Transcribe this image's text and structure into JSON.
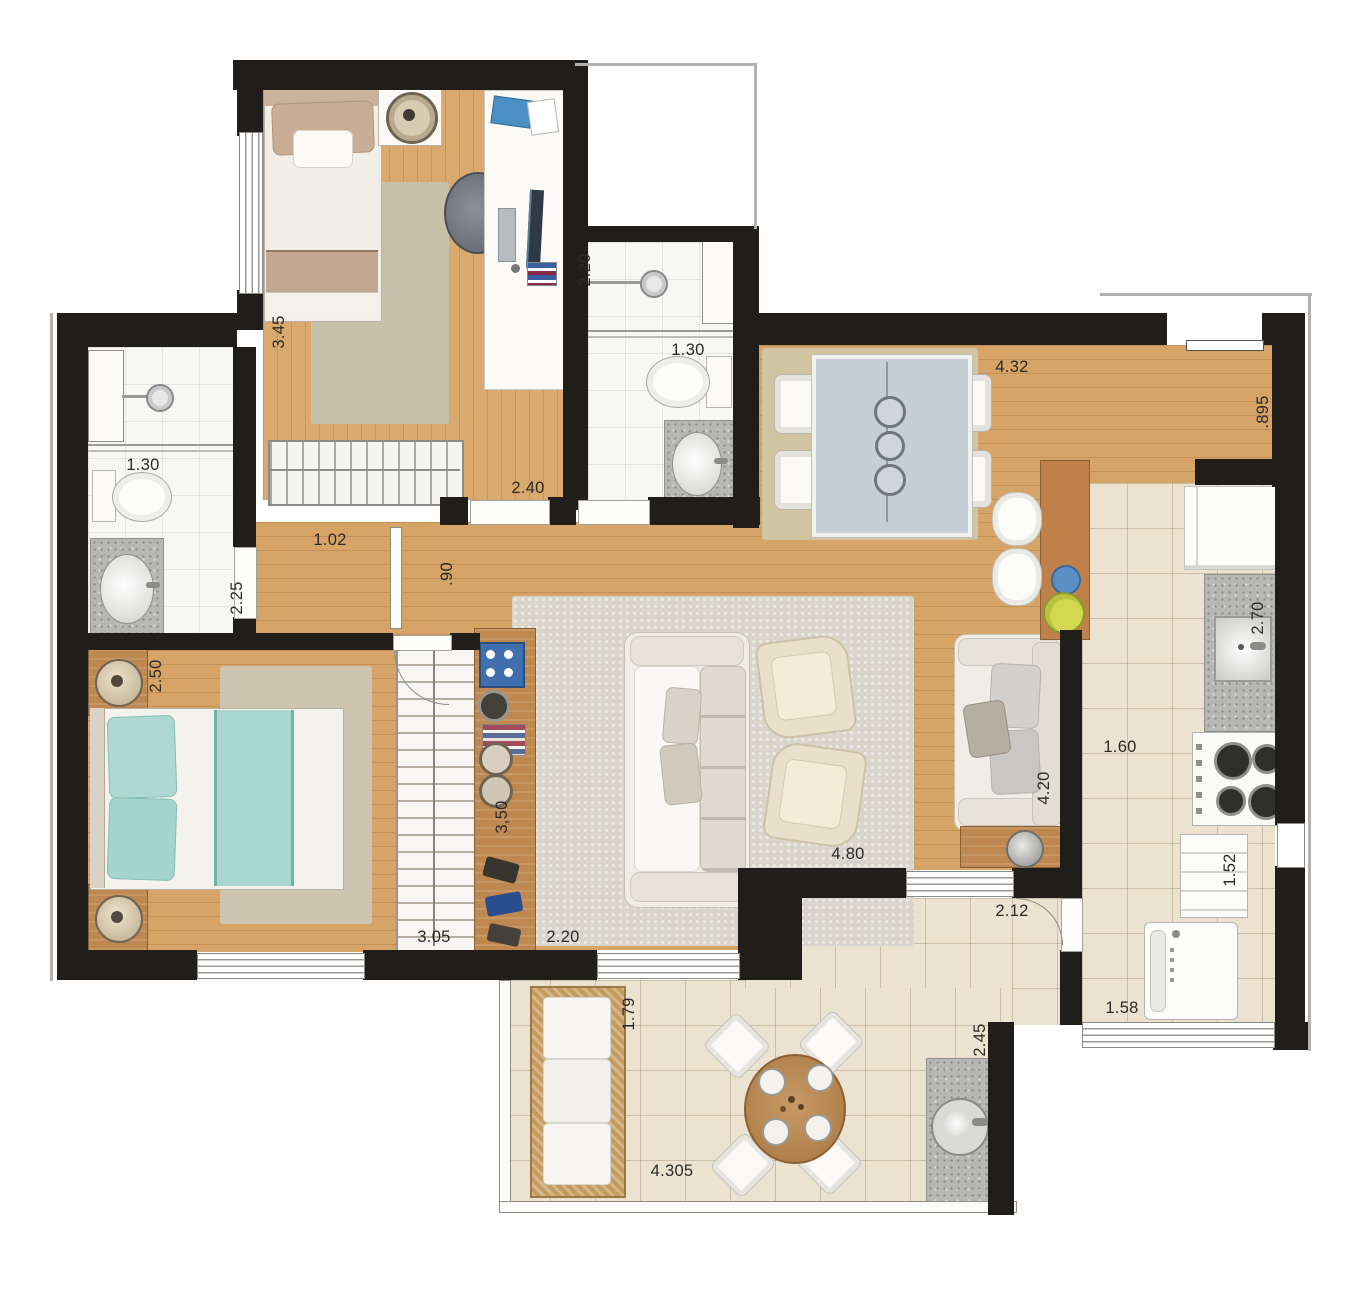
{
  "plan": {
    "type": "apartment floor plan, top-down 3D render",
    "colors": {
      "wall": "#201d1a",
      "wood_floor": "#d6a466",
      "wood_furniture": "#bf8850",
      "tile_white": "#f7f7f4",
      "tile_beige": "#ece2d0",
      "granite": "#b7b7b5",
      "rug_living": "#d9d5cc",
      "rug_dining": "#d0c5a0",
      "rug_bedroom": "#cdc5b0",
      "teal_bedding": "#aed9d3",
      "cream_seating": "#eae3d2",
      "wicker": "#c49a5e",
      "glass_table": "#c6cfd6",
      "console_blue": "#3f6fae",
      "label_text": "#2a2a28"
    }
  },
  "dimension_labels": [
    {
      "id": "bedroom1-depth",
      "text": "3.45",
      "orientation": "vertical"
    },
    {
      "id": "bathroom2-depth",
      "text": "2.20",
      "orientation": "vertical"
    },
    {
      "id": "bathroom2-width",
      "text": "1.30",
      "orientation": "horizontal"
    },
    {
      "id": "bedroom1-door",
      "text": "2.40",
      "orientation": "horizontal"
    },
    {
      "id": "hall-width",
      "text": "1.02",
      "orientation": "horizontal"
    },
    {
      "id": "hall-corridor",
      "text": ".90",
      "orientation": "vertical"
    },
    {
      "id": "bathroom1-width",
      "text": "1.30",
      "orientation": "horizontal"
    },
    {
      "id": "bathroom1-depth",
      "text": "2.25",
      "orientation": "vertical"
    },
    {
      "id": "bedroom2-width",
      "text": "2.50",
      "orientation": "vertical"
    },
    {
      "id": "bedroom2-depth",
      "text": "3.05",
      "orientation": "horizontal"
    },
    {
      "id": "living-depth",
      "text": "3,50",
      "orientation": "vertical"
    },
    {
      "id": "living-left-width",
      "text": "2.20",
      "orientation": "horizontal"
    },
    {
      "id": "living-width",
      "text": "4.80",
      "orientation": "horizontal"
    },
    {
      "id": "living-right-depth",
      "text": "4.20",
      "orientation": "vertical"
    },
    {
      "id": "dining-width",
      "text": "4.32",
      "orientation": "horizontal"
    },
    {
      "id": "entry-recess",
      "text": ".895",
      "orientation": "vertical"
    },
    {
      "id": "kitchen-counter",
      "text": "2.70",
      "orientation": "vertical"
    },
    {
      "id": "kitchen-width",
      "text": "1.60",
      "orientation": "horizontal"
    },
    {
      "id": "service-counter",
      "text": "1.52",
      "orientation": "vertical"
    },
    {
      "id": "service-width",
      "text": "1.58",
      "orientation": "horizontal"
    },
    {
      "id": "balcony-right-width",
      "text": "2.12",
      "orientation": "horizontal"
    },
    {
      "id": "balcony-right-depth",
      "text": "2.45",
      "orientation": "vertical"
    },
    {
      "id": "balcony-depth",
      "text": "1.79",
      "orientation": "vertical"
    },
    {
      "id": "balcony-width",
      "text": "4.305",
      "orientation": "horizontal"
    }
  ]
}
